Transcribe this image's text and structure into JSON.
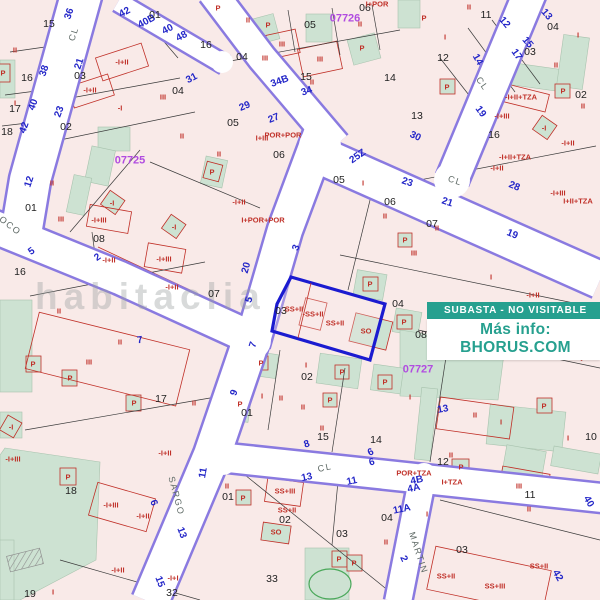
{
  "title": "Cadastral parcel map with auction overlay",
  "badge": {
    "status_text": "SUBASTA - NO VISITABLE",
    "info_text": "Más info: BHORUS.COM",
    "teal": "#26a08f"
  },
  "watermark": "habitaclia",
  "highlight": {
    "parcel": "03",
    "outline_color": "#1b1bd0",
    "labels": [
      "SS+II",
      "-SS+II",
      "SS+II",
      "SO"
    ]
  },
  "colors": {
    "parcel_fill": "#f9eae8",
    "courtyard_fill": "#cde2d2",
    "street_edge_purple": "#8a7ae0",
    "building_line_red": "#c03028",
    "street_number_blue": "#2326c8",
    "district_purple": "#b14ce0",
    "highlight_blue": "#1b1bd0",
    "pool_green": "#4aa85a"
  },
  "map": {
    "district_codes": [
      {
        "t": "07725",
        "x": 130,
        "y": 161
      },
      {
        "t": "07726",
        "x": 345,
        "y": 19
      },
      {
        "t": "07727",
        "x": 418,
        "y": 370
      }
    ],
    "street_names": [
      {
        "t": "CL",
        "x": 74,
        "y": 34,
        "r": -72
      },
      {
        "t": "CL",
        "x": 482,
        "y": 84,
        "r": 55
      },
      {
        "t": "CL",
        "x": 455,
        "y": 181,
        "r": 18
      },
      {
        "t": "CL",
        "x": 325,
        "y": 468,
        "r": -12
      },
      {
        "t": "OCO",
        "x": 10,
        "y": 226,
        "r": 38
      },
      {
        "t": "SARGO",
        "x": 176,
        "y": 496,
        "r": 75
      },
      {
        "t": "MARTIN",
        "x": 418,
        "y": 553,
        "r": 72
      }
    ],
    "street_numbers": [
      {
        "t": "36",
        "x": 70,
        "y": 14,
        "r": -72
      },
      {
        "t": "42",
        "x": 125,
        "y": 13,
        "r": -28
      },
      {
        "t": "40B",
        "x": 147,
        "y": 22,
        "r": -28
      },
      {
        "t": "40",
        "x": 168,
        "y": 30,
        "r": -28
      },
      {
        "t": "48",
        "x": 182,
        "y": 37,
        "r": -28
      },
      {
        "t": "31",
        "x": 192,
        "y": 79,
        "r": -28
      },
      {
        "t": "21",
        "x": 80,
        "y": 64,
        "r": -72
      },
      {
        "t": "38",
        "x": 45,
        "y": 71,
        "r": -72
      },
      {
        "t": "23",
        "x": 60,
        "y": 112,
        "r": -70
      },
      {
        "t": "40",
        "x": 34,
        "y": 105,
        "r": -70
      },
      {
        "t": "42",
        "x": 25,
        "y": 128,
        "r": -70
      },
      {
        "t": "34B",
        "x": 280,
        "y": 82,
        "r": -20
      },
      {
        "t": "34",
        "x": 307,
        "y": 92,
        "r": -20
      },
      {
        "t": "29",
        "x": 245,
        "y": 107,
        "r": -22
      },
      {
        "t": "27",
        "x": 274,
        "y": 119,
        "r": -22
      },
      {
        "t": "25Z",
        "x": 358,
        "y": 157,
        "r": -35
      },
      {
        "t": "12",
        "x": 504,
        "y": 23,
        "r": 50
      },
      {
        "t": "13",
        "x": 546,
        "y": 15,
        "r": 50
      },
      {
        "t": "15",
        "x": 527,
        "y": 43,
        "r": 50
      },
      {
        "t": "17",
        "x": 516,
        "y": 55,
        "r": 55
      },
      {
        "t": "14",
        "x": 477,
        "y": 60,
        "r": 60
      },
      {
        "t": "19",
        "x": 480,
        "y": 112,
        "r": 55
      },
      {
        "t": "30",
        "x": 415,
        "y": 137,
        "r": 25
      },
      {
        "t": "23",
        "x": 407,
        "y": 183,
        "r": 18
      },
      {
        "t": "21",
        "x": 447,
        "y": 203,
        "r": 18
      },
      {
        "t": "28",
        "x": 514,
        "y": 187,
        "r": 22
      },
      {
        "t": "19",
        "x": 512,
        "y": 235,
        "r": 22
      },
      {
        "t": "3",
        "x": 297,
        "y": 248,
        "r": -70
      },
      {
        "t": "20",
        "x": 247,
        "y": 268,
        "r": -75
      },
      {
        "t": "12",
        "x": 30,
        "y": 182,
        "r": -72
      },
      {
        "t": "5",
        "x": 32,
        "y": 252,
        "r": -35
      },
      {
        "t": "2",
        "x": 98,
        "y": 258,
        "r": -35
      },
      {
        "t": "5",
        "x": 250,
        "y": 300,
        "r": -72
      },
      {
        "t": "7",
        "x": 254,
        "y": 345,
        "r": -72
      },
      {
        "t": "9",
        "x": 235,
        "y": 393,
        "r": -70
      },
      {
        "t": "8",
        "x": 307,
        "y": 445,
        "r": -18
      },
      {
        "t": "6",
        "x": 371,
        "y": 453,
        "r": -25
      },
      {
        "t": "11",
        "x": 204,
        "y": 473,
        "r": -80
      },
      {
        "t": "13",
        "x": 307,
        "y": 478,
        "r": -12
      },
      {
        "t": "11",
        "x": 352,
        "y": 482,
        "r": -12
      },
      {
        "t": "6",
        "x": 372,
        "y": 463,
        "r": -15
      },
      {
        "t": "4B",
        "x": 417,
        "y": 481,
        "r": -12
      },
      {
        "t": "4A",
        "x": 414,
        "y": 489,
        "r": -12
      },
      {
        "t": "11A",
        "x": 402,
        "y": 510,
        "r": -12
      },
      {
        "t": "2",
        "x": 403,
        "y": 559,
        "r": 65
      },
      {
        "t": "40",
        "x": 588,
        "y": 502,
        "r": 60
      },
      {
        "t": "42",
        "x": 557,
        "y": 576,
        "r": 60
      },
      {
        "t": "6",
        "x": 153,
        "y": 503,
        "r": 70
      },
      {
        "t": "13",
        "x": 181,
        "y": 533,
        "r": 70
      },
      {
        "t": "15",
        "x": 159,
        "y": 582,
        "r": 70
      },
      {
        "t": "7",
        "x": 140,
        "y": 341,
        "r": -8
      },
      {
        "t": "13",
        "x": 443,
        "y": 410,
        "r": -10
      }
    ],
    "parcel_numbers": [
      {
        "t": "15",
        "x": 49,
        "y": 24
      },
      {
        "t": "01",
        "x": 155,
        "y": 15
      },
      {
        "t": "16",
        "x": 27,
        "y": 78
      },
      {
        "t": "17",
        "x": 15,
        "y": 109
      },
      {
        "t": "18",
        "x": 7,
        "y": 132
      },
      {
        "t": "03",
        "x": 80,
        "y": 76
      },
      {
        "t": "02",
        "x": 66,
        "y": 127
      },
      {
        "t": "04",
        "x": 178,
        "y": 91
      },
      {
        "t": "16",
        "x": 206,
        "y": 45
      },
      {
        "t": "04",
        "x": 242,
        "y": 57
      },
      {
        "t": "05",
        "x": 310,
        "y": 25
      },
      {
        "t": "06",
        "x": 365,
        "y": 8
      },
      {
        "t": "15",
        "x": 306,
        "y": 77
      },
      {
        "t": "14",
        "x": 390,
        "y": 78
      },
      {
        "t": "05",
        "x": 233,
        "y": 123
      },
      {
        "t": "11",
        "x": 486,
        "y": 15
      },
      {
        "t": "12",
        "x": 443,
        "y": 58
      },
      {
        "t": "13",
        "x": 417,
        "y": 116
      },
      {
        "t": "04",
        "x": 553,
        "y": 27
      },
      {
        "t": "03",
        "x": 530,
        "y": 52
      },
      {
        "t": "02",
        "x": 581,
        "y": 95
      },
      {
        "t": "16",
        "x": 494,
        "y": 135
      },
      {
        "t": "01",
        "x": 31,
        "y": 208
      },
      {
        "t": "08",
        "x": 99,
        "y": 239
      },
      {
        "t": "16",
        "x": 20,
        "y": 272
      },
      {
        "t": "06",
        "x": 279,
        "y": 155
      },
      {
        "t": "05",
        "x": 339,
        "y": 180
      },
      {
        "t": "06",
        "x": 390,
        "y": 202
      },
      {
        "t": "07",
        "x": 214,
        "y": 294
      },
      {
        "t": "07",
        "x": 432,
        "y": 224
      },
      {
        "t": "03",
        "x": 281,
        "y": 311
      },
      {
        "t": "04",
        "x": 398,
        "y": 304
      },
      {
        "t": "02",
        "x": 307,
        "y": 377
      },
      {
        "t": "01",
        "x": 247,
        "y": 413
      },
      {
        "t": "15",
        "x": 323,
        "y": 437
      },
      {
        "t": "14",
        "x": 376,
        "y": 440
      },
      {
        "t": "08",
        "x": 421,
        "y": 335
      },
      {
        "t": "10",
        "x": 591,
        "y": 437
      },
      {
        "t": "17",
        "x": 161,
        "y": 399
      },
      {
        "t": "18",
        "x": 71,
        "y": 491
      },
      {
        "t": "19",
        "x": 30,
        "y": 594
      },
      {
        "t": "32",
        "x": 172,
        "y": 593
      },
      {
        "t": "01",
        "x": 228,
        "y": 497
      },
      {
        "t": "02",
        "x": 285,
        "y": 520
      },
      {
        "t": "03",
        "x": 342,
        "y": 534
      },
      {
        "t": "04",
        "x": 387,
        "y": 518
      },
      {
        "t": "03",
        "x": 462,
        "y": 550
      },
      {
        "t": "11",
        "x": 530,
        "y": 495
      },
      {
        "t": "12",
        "x": 443,
        "y": 462
      },
      {
        "t": "33",
        "x": 272,
        "y": 579
      }
    ],
    "building_labels": [
      {
        "t": "II",
        "x": 15,
        "y": 50
      },
      {
        "t": "P",
        "x": 3,
        "y": 73
      },
      {
        "t": "I",
        "x": 15,
        "y": 103
      },
      {
        "t": "-I+II",
        "x": 122,
        "y": 62
      },
      {
        "t": "-I+II",
        "x": 90,
        "y": 90
      },
      {
        "t": "III",
        "x": 163,
        "y": 97
      },
      {
        "t": "-I",
        "x": 120,
        "y": 108
      },
      {
        "t": "II",
        "x": 182,
        "y": 136
      },
      {
        "t": "P",
        "x": 218,
        "y": 8
      },
      {
        "t": "II",
        "x": 248,
        "y": 20
      },
      {
        "t": "P",
        "x": 268,
        "y": 25
      },
      {
        "t": "III",
        "x": 282,
        "y": 44
      },
      {
        "t": "III",
        "x": 265,
        "y": 58
      },
      {
        "t": "III",
        "x": 320,
        "y": 59
      },
      {
        "t": "P",
        "x": 362,
        "y": 48
      },
      {
        "t": "II",
        "x": 312,
        "y": 82
      },
      {
        "t": "II",
        "x": 360,
        "y": 24
      },
      {
        "t": "I+POR",
        "x": 377,
        "y": 4
      },
      {
        "t": "POR+POR",
        "x": 283,
        "y": 135
      },
      {
        "t": "I+III",
        "x": 262,
        "y": 138
      },
      {
        "t": "II",
        "x": 469,
        "y": 7
      },
      {
        "t": "I",
        "x": 445,
        "y": 37
      },
      {
        "t": "P",
        "x": 424,
        "y": 18
      },
      {
        "t": "P",
        "x": 447,
        "y": 87
      },
      {
        "t": "I",
        "x": 578,
        "y": 35
      },
      {
        "t": "II",
        "x": 556,
        "y": 65
      },
      {
        "t": "-I+II+TZA",
        "x": 521,
        "y": 97
      },
      {
        "t": "-I+III",
        "x": 502,
        "y": 116
      },
      {
        "t": "-I",
        "x": 544,
        "y": 128
      },
      {
        "t": "P",
        "x": 563,
        "y": 91
      },
      {
        "t": "II",
        "x": 583,
        "y": 106
      },
      {
        "t": "-I+II",
        "x": 568,
        "y": 143
      },
      {
        "t": "-I+II+TZA",
        "x": 515,
        "y": 157
      },
      {
        "t": "-I+II",
        "x": 497,
        "y": 168
      },
      {
        "t": "II",
        "x": 52,
        "y": 183
      },
      {
        "t": "III",
        "x": 61,
        "y": 219
      },
      {
        "t": "-I",
        "x": 112,
        "y": 203
      },
      {
        "t": "-I+III",
        "x": 99,
        "y": 220
      },
      {
        "t": "-I+III",
        "x": 164,
        "y": 259
      },
      {
        "t": "-I+II",
        "x": 109,
        "y": 260
      },
      {
        "t": "-I",
        "x": 174,
        "y": 227
      },
      {
        "t": "-I+II",
        "x": 172,
        "y": 287
      },
      {
        "t": "II",
        "x": 219,
        "y": 154
      },
      {
        "t": "P",
        "x": 212,
        "y": 172
      },
      {
        "t": "-I+II",
        "x": 239,
        "y": 202
      },
      {
        "t": "I+POR+POR",
        "x": 263,
        "y": 220
      },
      {
        "t": "I",
        "x": 363,
        "y": 183
      },
      {
        "t": "II",
        "x": 385,
        "y": 216
      },
      {
        "t": "-I+III",
        "x": 558,
        "y": 193
      },
      {
        "t": "I+II+TZA",
        "x": 578,
        "y": 201
      },
      {
        "t": "III",
        "x": 414,
        "y": 253
      },
      {
        "t": "P",
        "x": 405,
        "y": 240
      },
      {
        "t": "I",
        "x": 491,
        "y": 277
      },
      {
        "t": "-I+II",
        "x": 533,
        "y": 295
      },
      {
        "t": "II",
        "x": 437,
        "y": 228
      },
      {
        "t": "SS+II",
        "x": 294,
        "y": 309
      },
      {
        "t": "-SS+II",
        "x": 313,
        "y": 314
      },
      {
        "t": "SS+II",
        "x": 335,
        "y": 323
      },
      {
        "t": "SO",
        "x": 366,
        "y": 331
      },
      {
        "t": "P",
        "x": 370,
        "y": 284
      },
      {
        "t": "P",
        "x": 404,
        "y": 322
      },
      {
        "t": "I",
        "x": 306,
        "y": 365
      },
      {
        "t": "P",
        "x": 261,
        "y": 363
      },
      {
        "t": "P",
        "x": 342,
        "y": 372
      },
      {
        "t": "P",
        "x": 385,
        "y": 382
      },
      {
        "t": "I",
        "x": 262,
        "y": 396
      },
      {
        "t": "II",
        "x": 281,
        "y": 398
      },
      {
        "t": "II",
        "x": 303,
        "y": 407
      },
      {
        "t": "P",
        "x": 330,
        "y": 400
      },
      {
        "t": "II",
        "x": 322,
        "y": 428
      },
      {
        "t": "P",
        "x": 240,
        "y": 404
      },
      {
        "t": "II",
        "x": 59,
        "y": 311
      },
      {
        "t": "II",
        "x": 120,
        "y": 342
      },
      {
        "t": "III",
        "x": 89,
        "y": 362
      },
      {
        "t": "P",
        "x": 33,
        "y": 364
      },
      {
        "t": "P",
        "x": 70,
        "y": 378
      },
      {
        "t": "P",
        "x": 134,
        "y": 403
      },
      {
        "t": "II",
        "x": 194,
        "y": 403
      },
      {
        "t": "-I",
        "x": 11,
        "y": 427
      },
      {
        "t": "-I+II",
        "x": 165,
        "y": 453
      },
      {
        "t": "P",
        "x": 68,
        "y": 477
      },
      {
        "t": "-I+III",
        "x": 13,
        "y": 459
      },
      {
        "t": "-I+III",
        "x": 111,
        "y": 505
      },
      {
        "t": "-I+II",
        "x": 143,
        "y": 516
      },
      {
        "t": "-I+II",
        "x": 118,
        "y": 570
      },
      {
        "t": "-I+I",
        "x": 173,
        "y": 578
      },
      {
        "t": "I",
        "x": 53,
        "y": 592
      },
      {
        "t": "II",
        "x": 227,
        "y": 486
      },
      {
        "t": "P",
        "x": 243,
        "y": 498
      },
      {
        "t": "SS+III",
        "x": 285,
        "y": 491
      },
      {
        "t": "SS+II",
        "x": 287,
        "y": 510
      },
      {
        "t": "SO",
        "x": 276,
        "y": 532
      },
      {
        "t": "I",
        "x": 427,
        "y": 514
      },
      {
        "t": "II",
        "x": 386,
        "y": 542
      },
      {
        "t": "P",
        "x": 339,
        "y": 559
      },
      {
        "t": "P",
        "x": 354,
        "y": 563
      },
      {
        "t": "SS+II",
        "x": 446,
        "y": 576
      },
      {
        "t": "SS+III",
        "x": 495,
        "y": 586
      },
      {
        "t": "SS+II",
        "x": 539,
        "y": 566
      },
      {
        "t": "II",
        "x": 451,
        "y": 455
      },
      {
        "t": "I+TZA",
        "x": 452,
        "y": 482
      },
      {
        "t": "POR+TZA",
        "x": 414,
        "y": 473
      },
      {
        "t": "III",
        "x": 519,
        "y": 486
      },
      {
        "t": "II",
        "x": 529,
        "y": 509
      },
      {
        "t": "P",
        "x": 461,
        "y": 467
      },
      {
        "t": "I",
        "x": 410,
        "y": 397
      },
      {
        "t": "II",
        "x": 475,
        "y": 415
      },
      {
        "t": "I",
        "x": 501,
        "y": 422
      },
      {
        "t": "-I",
        "x": 548,
        "y": 340
      },
      {
        "t": "-I",
        "x": 578,
        "y": 350
      },
      {
        "t": "P",
        "x": 544,
        "y": 406
      },
      {
        "t": "I",
        "x": 568,
        "y": 438
      }
    ]
  }
}
